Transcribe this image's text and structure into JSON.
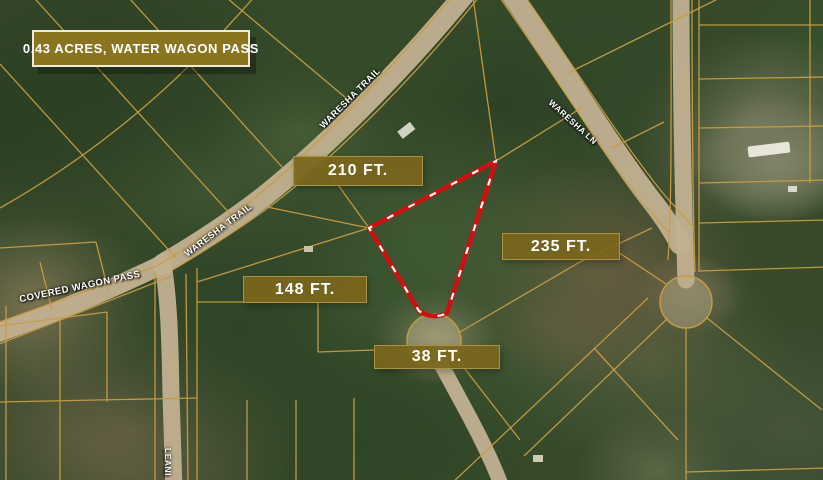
{
  "title_badge": {
    "label": "0.43 ACRES, WATER WAGON PASS"
  },
  "measurements": [
    {
      "id": "north-side",
      "label": "210 FT."
    },
    {
      "id": "east-side",
      "label": "235 FT."
    },
    {
      "id": "southwest-side",
      "label": "148 FT."
    },
    {
      "id": "south-side",
      "label": "38 FT."
    }
  ],
  "streets": [
    {
      "id": "waresha-trail-upper",
      "name": "WARESHA TRAIL"
    },
    {
      "id": "waresha-trail-lower",
      "name": "WARESHA TRAIL"
    },
    {
      "id": "waresha-ln",
      "name": "WARESHA LN"
    },
    {
      "id": "covered-wagon-pass",
      "name": "COVERED WAGON PASS"
    },
    {
      "id": "leaning-road-partial",
      "name": "LEANI"
    }
  ],
  "map": {
    "type": "satellite-parcel-map",
    "subject_parcel_color": "#cf1010",
    "parcel_line_color": "#c99c3f",
    "road_color": "#c2b191",
    "label_bg_color": "#7a661c",
    "title_bg_color": "#8a741f"
  }
}
